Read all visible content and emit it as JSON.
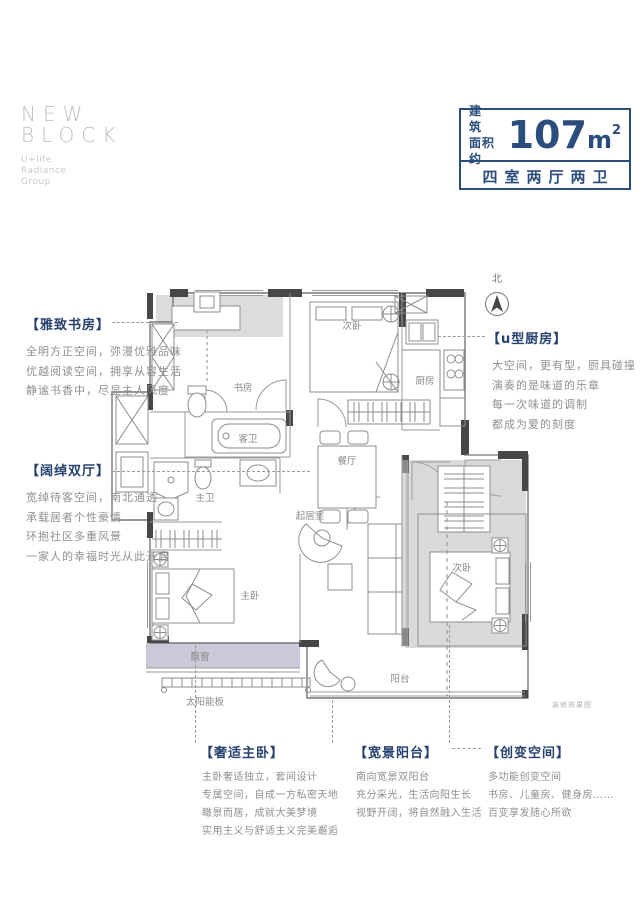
{
  "logo": {
    "line1": "NEW",
    "line2": "BLOCK",
    "tagline": [
      "U+life",
      "Radiance",
      "Group"
    ]
  },
  "area_box": {
    "label_line1": "建筑",
    "label_line2": "面积约",
    "value": "107",
    "unit": "m",
    "sup": "2",
    "layout": "四室两厅两卫",
    "accent_color": "#2b4d7e"
  },
  "north": {
    "label": "北"
  },
  "plan": {
    "rooms": {
      "study": "书房",
      "bedroom_top": "次卧",
      "kitchen": "厨房",
      "guest_bath": "客卫",
      "dining": "餐厅",
      "master_bath": "主卫",
      "living": "起居室",
      "master_bedroom": "主卧",
      "bedroom_right": "次卧",
      "balcony": "阳台",
      "bay_window": "飘窗",
      "solar_panel": "太阳能板"
    },
    "caption": "装修效果图"
  },
  "annotations": {
    "study": {
      "title": "【雅致书房】",
      "lines": [
        "全明方正空间，弥漫优雅品味",
        "优越阅读空间，拥享从容生活",
        "静谧书香中，尽显主人风度"
      ]
    },
    "halls": {
      "title": "【阔绰双厅】",
      "lines": [
        "宽绰待客空间，南北通透",
        "承载居者个性豪情",
        "环抱社区多重风景",
        "一家人的幸福时光从此开启"
      ]
    },
    "kitchen": {
      "title": "【u型厨房】",
      "lines": [
        "大空间，更有型，厨具碰撞",
        "演奏的是味道的乐章",
        "每一次味道的调制",
        "都成为爱的刻度"
      ]
    },
    "master": {
      "title": "【奢适主卧】",
      "lines": [
        "主卧奢适独立，套间设计",
        "专属空间，自成一方私密天地",
        "瞰景而居，成就大美梦境",
        "实用主义与舒适主义完美邂逅"
      ]
    },
    "balcony": {
      "title": "【宽景阳台】",
      "lines": [
        "南向宽景双阳台",
        "充分采光，生活向阳生长",
        "视野开阔，将自然融入生活"
      ]
    },
    "flex": {
      "title": "【创变空间】",
      "lines": [
        "多功能创变空间",
        "书房、儿童房、健身房……",
        "百变享发随心所欲"
      ]
    }
  }
}
